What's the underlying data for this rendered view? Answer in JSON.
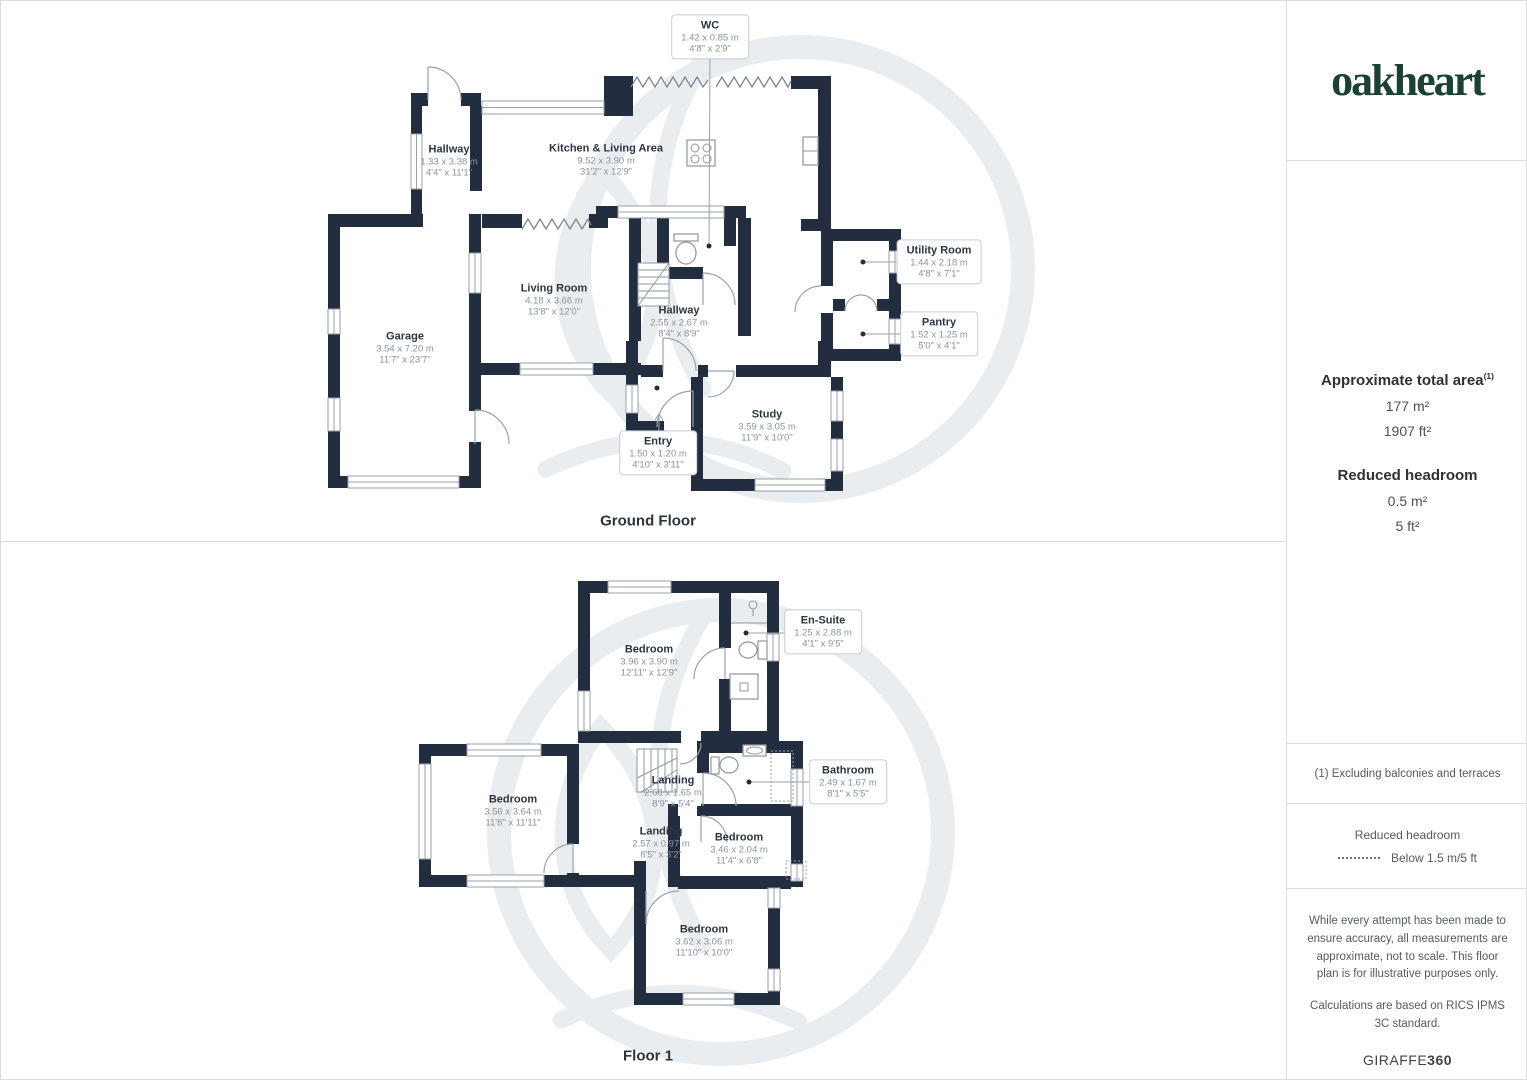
{
  "sidebar": {
    "logo": "oakheart",
    "area_title": "Approximate total area",
    "area_sup": "(1)",
    "area_m2": "177 m²",
    "area_ft2": "1907 ft²",
    "reduced_title": "Reduced headroom",
    "reduced_m2": "0.5 m²",
    "reduced_ft2": "5 ft²",
    "footnote": "(1) Excluding balconies and terraces",
    "legend_title": "Reduced headroom",
    "legend_value": "Below 1.5 m/5 ft",
    "disclaimer1": "While every attempt has been made to ensure accuracy, all measurements are approximate, not to scale. This floor plan is for illustrative purposes only.",
    "disclaimer2": "Calculations are based on RICS IPMS 3C standard.",
    "brand": "GIRAFFE",
    "brand_suffix": "360"
  },
  "colors": {
    "wall": "#222e40",
    "logo_green": "#1b4036",
    "room_text": "#2c3544",
    "dim_text": "#8d939b"
  },
  "floors": {
    "ground": {
      "title": "Ground Floor",
      "rooms": [
        {
          "name": "WC",
          "metric": "1.42 x 0.85 m",
          "imperial": "4'8\" x 2'9\""
        },
        {
          "name": "Hallway",
          "metric": "1.33 x 3.38 m",
          "imperial": "4'4\" x 11'1\""
        },
        {
          "name": "Kitchen & Living Area",
          "metric": "9.52 x 3.90 m",
          "imperial": "31'2\" x 12'9\""
        },
        {
          "name": "Utility Room",
          "metric": "1.44 x 2.18 m",
          "imperial": "4'8\" x 7'1\""
        },
        {
          "name": "Living Room",
          "metric": "4.18 x 3.66 m",
          "imperial": "13'8\" x 12'0\""
        },
        {
          "name": "Hallway",
          "metric": "2.55 x 2.67 m",
          "imperial": "8'4\" x 8'9\""
        },
        {
          "name": "Pantry",
          "metric": "1.52 x 1.25 m",
          "imperial": "5'0\" x 4'1\""
        },
        {
          "name": "Garage",
          "metric": "3.54 x 7.20 m",
          "imperial": "11'7\" x 23'7\""
        },
        {
          "name": "Study",
          "metric": "3.59 x 3.05 m",
          "imperial": "11'9\" x 10'0\""
        },
        {
          "name": "Entry",
          "metric": "1.50 x 1.20 m",
          "imperial": "4'10\" x 3'11\""
        }
      ]
    },
    "first": {
      "title": "Floor 1",
      "rooms": [
        {
          "name": "Bedroom",
          "metric": "3.96 x 3.90 m",
          "imperial": "12'11\" x 12'9\""
        },
        {
          "name": "En-Suite",
          "metric": "1.25 x 2.88 m",
          "imperial": "4'1\" x 9'5\""
        },
        {
          "name": "Bedroom",
          "metric": "3.56 x 3.64 m",
          "imperial": "11'8\" x 11'11\""
        },
        {
          "name": "Landing",
          "metric": "2.68 x 1.65 m",
          "imperial": "8'9\" x 5'4\""
        },
        {
          "name": "Bathroom",
          "metric": "2.49 x 1.67 m",
          "imperial": "8'1\" x 5'5\""
        },
        {
          "name": "Landing",
          "metric": "2.57 x 0.97 m",
          "imperial": "8'5\" x 3'2\""
        },
        {
          "name": "Bedroom",
          "metric": "3.46 x 2.04 m",
          "imperial": "11'4\" x 6'8\""
        },
        {
          "name": "Bedroom",
          "metric": "3.62 x 3.06 m",
          "imperial": "11'10\" x 10'0\""
        }
      ]
    }
  }
}
